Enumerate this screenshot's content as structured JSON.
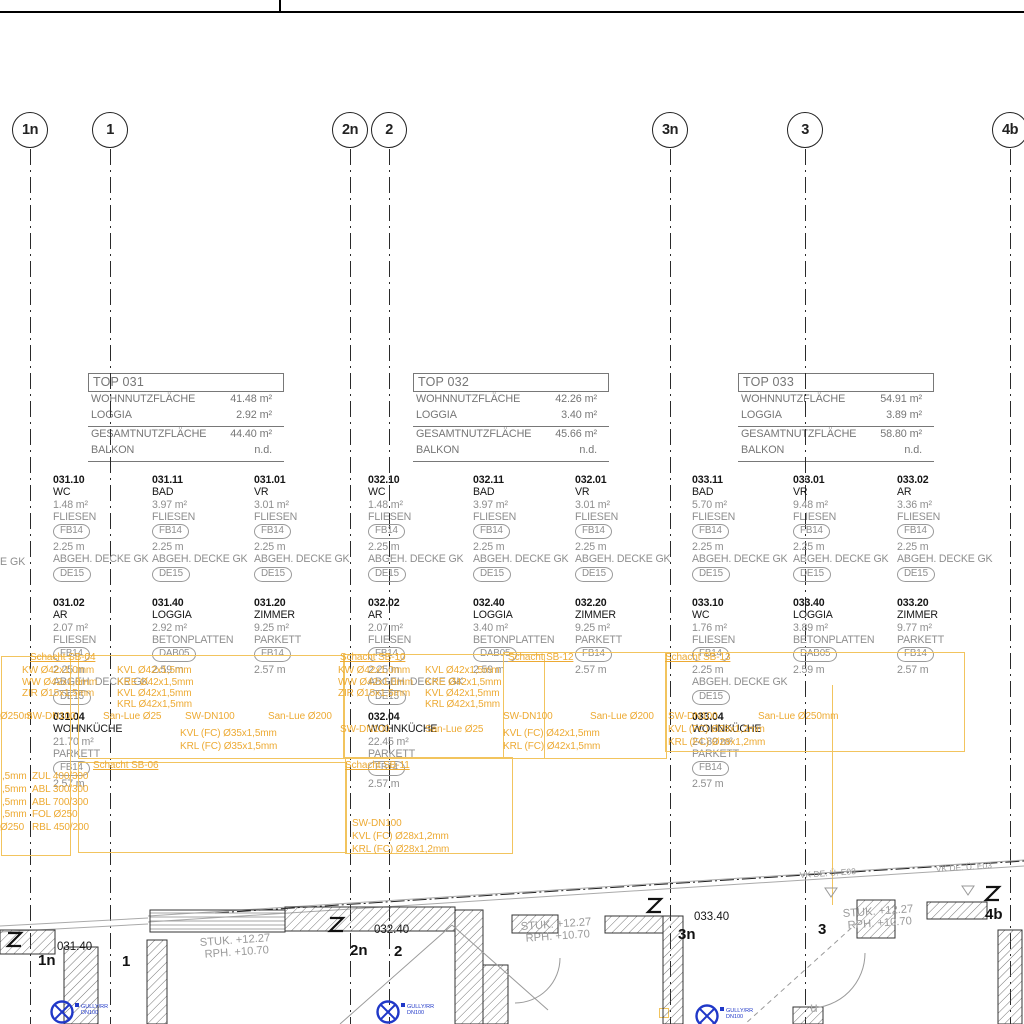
{
  "colors": {
    "annotation": "#edaa33",
    "annotation_box": "#f2c45e",
    "drain_blue": "#2038c8",
    "secondary_gray": "#8e8e8e",
    "line_black": "#222222"
  },
  "drawing": {
    "edge_fragment": "E GK",
    "grid_top": [
      {
        "label": "1n",
        "x": 30
      },
      {
        "label": "1",
        "x": 110
      },
      {
        "label": "2n",
        "x": 350
      },
      {
        "label": "2",
        "x": 389
      },
      {
        "label": "3n",
        "x": 670
      },
      {
        "label": "3",
        "x": 805
      },
      {
        "label": "4b",
        "x": 1010
      }
    ],
    "unit_tables": [
      {
        "title": "TOP 031",
        "row1_label": "WOHNNUTZFLÄCHE",
        "row1_value": "41.48 m²",
        "row2_label": "LOGGIA",
        "row2_value": "2.92 m²",
        "row3_label": "GESAMTNUTZFLÄCHE",
        "row3_value": "44.40 m²",
        "row4_label": "BALKON",
        "row4_value": "n.d."
      },
      {
        "title": "TOP 032",
        "row1_label": "WOHNNUTZFLÄCHE",
        "row1_value": "42.26 m²",
        "row2_label": "LOGGIA",
        "row2_value": "3.40 m²",
        "row3_label": "GESAMTNUTZFLÄCHE",
        "row3_value": "45.66 m²",
        "row4_label": "BALKON",
        "row4_value": "n.d."
      },
      {
        "title": "TOP 033",
        "row1_label": "WOHNNUTZFLÄCHE",
        "row1_value": "54.91 m²",
        "row2_label": "LOGGIA",
        "row2_value": "3.89 m²",
        "row3_label": "GESAMTNUTZFLÄCHE",
        "row3_value": "58.80 m²",
        "row4_label": "BALKON",
        "row4_value": "n.d."
      }
    ],
    "rooms": [
      {
        "x": 53,
        "y": 474,
        "number": "031.10",
        "name": "WC",
        "area": "1.48 m²",
        "floor": "FLIESEN",
        "floor_tag": "FB14",
        "height": "2.25 m",
        "ceiling": "ABGEH. DECKE GK",
        "ceiling_tag": "DE15"
      },
      {
        "x": 152,
        "y": 474,
        "number": "031.11",
        "name": "BAD",
        "area": "3.97 m²",
        "floor": "FLIESEN",
        "floor_tag": "FB14",
        "height": "2.25 m",
        "ceiling": "ABGEH. DECKE GK",
        "ceiling_tag": "DE15"
      },
      {
        "x": 254,
        "y": 474,
        "number": "031.01",
        "name": "VR",
        "area": "3.01 m²",
        "floor": "FLIESEN",
        "floor_tag": "FB14",
        "height": "2.25 m",
        "ceiling": "ABGEH. DECKE GK",
        "ceiling_tag": "DE15"
      },
      {
        "x": 368,
        "y": 474,
        "number": "032.10",
        "name": "WC",
        "area": "1.48 m²",
        "floor": "FLIESEN",
        "floor_tag": "FB14",
        "height": "2.25 m",
        "ceiling": "ABGEH. DECKE GK",
        "ceiling_tag": "DE15"
      },
      {
        "x": 473,
        "y": 474,
        "number": "032.11",
        "name": "BAD",
        "area": "3.97 m²",
        "floor": "FLIESEN",
        "floor_tag": "FB14",
        "height": "2.25 m",
        "ceiling": "ABGEH. DECKE GK",
        "ceiling_tag": "DE15"
      },
      {
        "x": 575,
        "y": 474,
        "number": "032.01",
        "name": "VR",
        "area": "3.01 m²",
        "floor": "FLIESEN",
        "floor_tag": "FB14",
        "height": "2.25 m",
        "ceiling": "ABGEH. DECKE GK",
        "ceiling_tag": "DE15"
      },
      {
        "x": 692,
        "y": 474,
        "number": "033.11",
        "name": "BAD",
        "area": "5.70 m²",
        "floor": "FLIESEN",
        "floor_tag": "FB14",
        "height": "2.25 m",
        "ceiling": "ABGEH. DECKE GK",
        "ceiling_tag": "DE15"
      },
      {
        "x": 793,
        "y": 474,
        "number": "033.01",
        "name": "VR",
        "area": "9.48 m²",
        "floor": "FLIESEN",
        "floor_tag": "FB14",
        "height": "2.25 m",
        "ceiling": "ABGEH. DECKE GK",
        "ceiling_tag": "DE15"
      },
      {
        "x": 897,
        "y": 474,
        "number": "033.02",
        "name": "AR",
        "area": "3.36 m²",
        "floor": "FLIESEN",
        "floor_tag": "FB14",
        "height": "2.25 m",
        "ceiling": "ABGEH. DECKE GK",
        "ceiling_tag": "DE15"
      },
      {
        "x": 53,
        "y": 597,
        "number": "031.02",
        "name": "AR",
        "area": "2.07 m²",
        "floor": "FLIESEN",
        "floor_tag": "FB14",
        "height": "2.25 m",
        "ceiling": "ABGEH. DECKE GK",
        "ceiling_tag": "DE15"
      },
      {
        "x": 152,
        "y": 597,
        "number": "031.40",
        "name": "LOGGIA",
        "area": "2.92 m²",
        "floor": "BETONPLATTEN",
        "floor_tag": "DAB05",
        "height": "2.59 m",
        "ceiling": null,
        "ceiling_tag": null
      },
      {
        "x": 254,
        "y": 597,
        "number": "031.20",
        "name": "ZIMMER",
        "area": "9.25 m²",
        "floor": "PARKETT",
        "floor_tag": "FB14",
        "height": "2.57 m",
        "ceiling": null,
        "ceiling_tag": null
      },
      {
        "x": 368,
        "y": 597,
        "number": "032.02",
        "name": "AR",
        "area": "2.07 m²",
        "floor": "FLIESEN",
        "floor_tag": "FB14",
        "height": "2.25 m",
        "ceiling": "ABGEH. DECKE GK",
        "ceiling_tag": "DE15"
      },
      {
        "x": 473,
        "y": 597,
        "number": "032.40",
        "name": "LOGGIA",
        "area": "3.40 m²",
        "floor": "BETONPLATTEN",
        "floor_tag": "DAB05",
        "height": "2.59 m",
        "ceiling": null,
        "ceiling_tag": null
      },
      {
        "x": 575,
        "y": 597,
        "number": "032.20",
        "name": "ZIMMER",
        "area": "9.25 m²",
        "floor": "PARKETT",
        "floor_tag": "FB14",
        "height": "2.57 m",
        "ceiling": null,
        "ceiling_tag": null
      },
      {
        "x": 692,
        "y": 597,
        "number": "033.10",
        "name": "WC",
        "area": "1.76 m²",
        "floor": "FLIESEN",
        "floor_tag": "FB14",
        "height": "2.25 m",
        "ceiling": "ABGEH. DECKE GK",
        "ceiling_tag": "DE15"
      },
      {
        "x": 793,
        "y": 597,
        "number": "033.40",
        "name": "LOGGIA",
        "area": "3.89 m²",
        "floor": "BETONPLATTEN",
        "floor_tag": "DAB05",
        "height": "2.59 m",
        "ceiling": null,
        "ceiling_tag": null
      },
      {
        "x": 897,
        "y": 597,
        "number": "033.20",
        "name": "ZIMMER",
        "area": "9.77 m²",
        "floor": "PARKETT",
        "floor_tag": "FB14",
        "height": "2.57 m",
        "ceiling": null,
        "ceiling_tag": null
      },
      {
        "x": 53,
        "y": 711,
        "number": "031.04",
        "name": "WOHNKÜCHE",
        "area": "21.70 m²",
        "floor": "PARKETT",
        "floor_tag": "FB14",
        "height": "2.57 m",
        "ceiling": null,
        "ceiling_tag": null
      },
      {
        "x": 368,
        "y": 711,
        "number": "032.04",
        "name": "WOHNKÜCHE",
        "area": "22.45 m²",
        "floor": "PARKETT",
        "floor_tag": "FB14",
        "height": "2.57 m",
        "ceiling": null,
        "ceiling_tag": null
      },
      {
        "x": 692,
        "y": 711,
        "number": "033.04",
        "name": "WOHNKÜCHE",
        "area": "24.89 m²",
        "floor": "PARKETT",
        "floor_tag": "FB14",
        "height": "2.57 m",
        "ceiling": null,
        "ceiling_tag": null
      }
    ],
    "annotations": {
      "boxes": [
        {
          "x": 1,
          "y": 656,
          "w": 68,
          "h": 198
        },
        {
          "x": 78,
          "y": 655,
          "w": 265,
          "h": 102
        },
        {
          "x": 78,
          "y": 762,
          "w": 267,
          "h": 89
        },
        {
          "x": 345,
          "y": 757,
          "w": 166,
          "h": 95
        },
        {
          "x": 343,
          "y": 654,
          "w": 200,
          "h": 103
        },
        {
          "x": 503,
          "y": 652,
          "w": 162,
          "h": 105
        },
        {
          "x": 665,
          "y": 652,
          "w": 298,
          "h": 98
        }
      ],
      "vlines": [
        {
          "x": 832,
          "y": 685,
          "h": 220
        }
      ],
      "texts": [
        {
          "t": "Schacht SB-04",
          "x": 30,
          "y": 652,
          "u": 1
        },
        {
          "t": "KW Ø42x1,0mm",
          "x": 22,
          "y": 665
        },
        {
          "t": "KVL Ø42x1,5mm",
          "x": 117,
          "y": 665
        },
        {
          "t": "WW Ø42x1,0mm",
          "x": 22,
          "y": 677
        },
        {
          "t": "KRE Ø42x1,5mm",
          "x": 117,
          "y": 677
        },
        {
          "t": "ZIR Ø15x1,5mm",
          "x": 22,
          "y": 688
        },
        {
          "t": "KVL Ø42x1,5mm",
          "x": 117,
          "y": 688
        },
        {
          "t": "KRL Ø42x1,5mm",
          "x": 117,
          "y": 699
        },
        {
          "t": "Ø250m",
          "x": 0,
          "y": 711
        },
        {
          "t": "SW-DN100",
          "x": 26,
          "y": 711
        },
        {
          "t": "San-Lue Ø25",
          "x": 103,
          "y": 711
        },
        {
          "t": "SW-DN100",
          "x": 185,
          "y": 711
        },
        {
          "t": "San-Lue Ø200",
          "x": 268,
          "y": 711
        },
        {
          "t": "KVL (FC) Ø35x1,5mm",
          "x": 180,
          "y": 728
        },
        {
          "t": "KRL (FC) Ø35x1,5mm",
          "x": 180,
          "y": 741
        },
        {
          "t": "Schacht SB-06",
          "x": 93,
          "y": 760,
          "u": 1
        },
        {
          "t": ",5mm",
          "x": 2,
          "y": 771
        },
        {
          "t": "ZUL 400/300",
          "x": 32,
          "y": 771
        },
        {
          "t": ",5mm",
          "x": 2,
          "y": 784
        },
        {
          "t": "ABL 300/300",
          "x": 32,
          "y": 784
        },
        {
          "t": ",5mm",
          "x": 2,
          "y": 797
        },
        {
          "t": "ABL 700/300",
          "x": 32,
          "y": 797
        },
        {
          "t": ",5mm",
          "x": 2,
          "y": 809
        },
        {
          "t": "FOL Ø250",
          "x": 32,
          "y": 809
        },
        {
          "t": "Ø250",
          "x": 0,
          "y": 822
        },
        {
          "t": "RBL 450/200",
          "x": 32,
          "y": 822
        },
        {
          "t": "Schacht SB-10",
          "x": 340,
          "y": 652,
          "u": 1
        },
        {
          "t": "KW Ø42x1,0mm",
          "x": 338,
          "y": 665
        },
        {
          "t": "KVL Ø42x1,5mm",
          "x": 425,
          "y": 665
        },
        {
          "t": "WW Ø42x1,0mm",
          "x": 338,
          "y": 677
        },
        {
          "t": "KRE Ø42x1,5mm",
          "x": 425,
          "y": 677
        },
        {
          "t": "ZIR Ø15x1,5mm",
          "x": 338,
          "y": 688
        },
        {
          "t": "KVL Ø42x1,5mm",
          "x": 425,
          "y": 688
        },
        {
          "t": "KRL Ø42x1,5mm",
          "x": 425,
          "y": 699
        },
        {
          "t": "Schacht SB-12",
          "x": 508,
          "y": 652,
          "u": 1
        },
        {
          "t": "SW-DN100",
          "x": 503,
          "y": 711
        },
        {
          "t": "San-Lue Ø200",
          "x": 590,
          "y": 711
        },
        {
          "t": "SW-DN100",
          "x": 340,
          "y": 724
        },
        {
          "t": "San-Lue Ø25",
          "x": 425,
          "y": 724
        },
        {
          "t": "KVL (FC) Ø42x1,5mm",
          "x": 503,
          "y": 728
        },
        {
          "t": "KRL (FC) Ø42x1,5mm",
          "x": 503,
          "y": 741
        },
        {
          "t": "Schacht SB-11",
          "x": 345,
          "y": 760,
          "u": 1
        },
        {
          "t": "SW-DN100",
          "x": 352,
          "y": 818
        },
        {
          "t": "KVL (FC) Ø28x1,2mm",
          "x": 352,
          "y": 831
        },
        {
          "t": "KRL (FC) Ø28x1,2mm",
          "x": 352,
          "y": 844
        },
        {
          "t": "Schacht SB-13",
          "x": 665,
          "y": 652,
          "u": 1
        },
        {
          "t": "SW-DN100",
          "x": 668,
          "y": 711
        },
        {
          "t": "San-Lue Ø250mm",
          "x": 758,
          "y": 711
        },
        {
          "t": "KVL (FC) Ø28x1,2mm",
          "x": 668,
          "y": 724
        },
        {
          "t": "KRL (FC) Ø28x1,2mm",
          "x": 668,
          "y": 737
        }
      ]
    },
    "plan": {
      "stuk_labels": [
        {
          "x": 200,
          "y": 946,
          "l1": "STUK. +12.27",
          "l2": "RPH. +10.70"
        },
        {
          "x": 521,
          "y": 930,
          "l1": "STUK. +12.27",
          "l2": "RPH. +10.70"
        },
        {
          "x": 843,
          "y": 917,
          "l1": "STUK. +12.27",
          "l2": "RPH. +10.70"
        }
      ],
      "room_refs": [
        {
          "x": 57,
          "y": 950,
          "t": "031.40"
        },
        {
          "x": 374,
          "y": 933,
          "t": "032.40"
        },
        {
          "x": 694,
          "y": 920,
          "t": "033.40"
        }
      ],
      "vk_labels": [
        {
          "x": 800,
          "y": 878,
          "t": "VK DE. Ü. E03"
        },
        {
          "x": 936,
          "y": 872,
          "t": "VK DE. Ü. E03"
        }
      ],
      "grid_labels": [
        {
          "x": 38,
          "y": 952,
          "t": "1n"
        },
        {
          "x": 122,
          "y": 953,
          "t": "1"
        },
        {
          "x": 350,
          "y": 942,
          "t": "2n"
        },
        {
          "x": 394,
          "y": 943,
          "t": "2"
        },
        {
          "x": 678,
          "y": 926,
          "t": "3n"
        },
        {
          "x": 818,
          "y": 921,
          "t": "3"
        },
        {
          "x": 985,
          "y": 906,
          "t": "4b"
        }
      ],
      "gully_label_1": "GULLY/RR",
      "gully_label_2": "DN100",
      "misc_label": {
        "x": 810,
        "y": 1000,
        "t": "u"
      }
    }
  }
}
